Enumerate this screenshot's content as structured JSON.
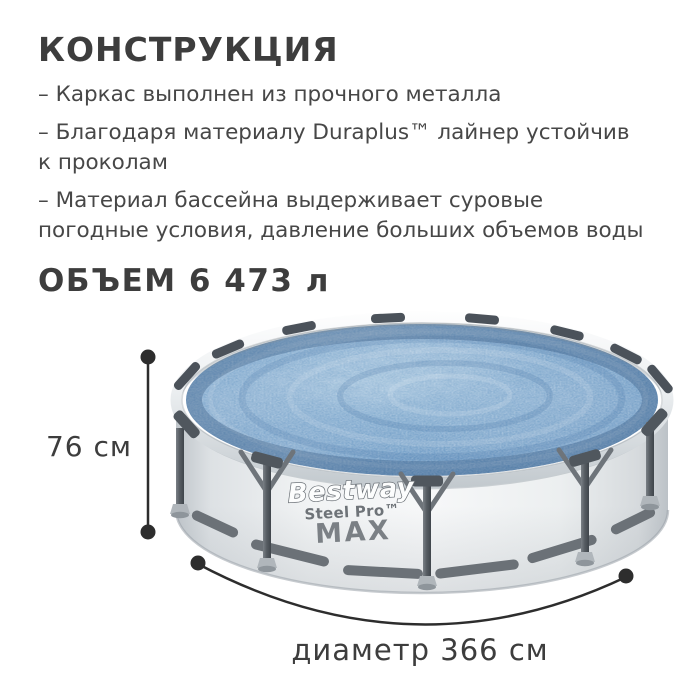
{
  "title": "КОНСТРУКЦИЯ",
  "features": [
    "– Каркас выполнен из прочного металла",
    "– Благодаря материалу Duraplus™ лайнер устойчив\nк проколам",
    "– Материал бассейна выдерживает суровые\nпогодные условия, давление больших объемов воды"
  ],
  "volume_label": "ОБЪЕМ 6 473 л",
  "pool": {
    "brand": "Bestway",
    "series": "Steel Pro™",
    "model": "MAX"
  },
  "dimensions": {
    "height_label": "76 см",
    "diameter_label": "диаметр 366 см"
  },
  "colors": {
    "heading_text": "#3d3d3d",
    "body_text": "#474747",
    "annotation": "#2d2d2d",
    "water_base": "#6d9ac6",
    "water_dark": "#3a6ea5",
    "frame_gray": "#565c62",
    "wall_light": "#f2f4f5",
    "rim_white": "#fafbfc"
  }
}
